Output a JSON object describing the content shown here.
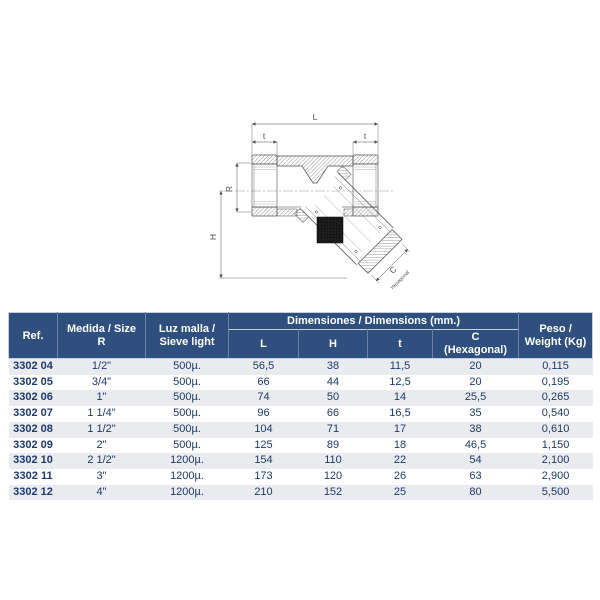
{
  "colors": {
    "header_bg": "#2F4F7F",
    "header_text": "#FFFFFF",
    "row_alt_bg": "#E9EBEE",
    "body_text": "#1E3A6E",
    "drawing_line": "#4F4F4F",
    "mesh_fill": "#161616",
    "page_bg": "#FFFFFF"
  },
  "diagram": {
    "labels": {
      "l": "L",
      "t_left": "t",
      "t_right": "t",
      "r": "R",
      "h": "H",
      "c": "C",
      "hexagonal": "Hexagonal"
    }
  },
  "table": {
    "header": {
      "ref": "Ref.",
      "size_l1": "Medida / Size",
      "size_l2": "R",
      "sieve_l1": "Luz malla /",
      "sieve_l2": "Sieve light",
      "dims_group": "Dimensiones / Dimensions (mm.)",
      "dim_l": "L",
      "dim_h": "H",
      "dim_t": "t",
      "dim_c_l1": "C",
      "dim_c_l2": "(Hexagonal)",
      "weight_l1": "Peso /",
      "weight_l2": "Weight (Kg)"
    },
    "rows": [
      [
        "3302 04",
        "1/2\"",
        "500µ.",
        "56,5",
        "38",
        "11,5",
        "20",
        "0,115"
      ],
      [
        "3302 05",
        "3/4\"",
        "500µ.",
        "66",
        "44",
        "12,5",
        "20",
        "0,195"
      ],
      [
        "3302 06",
        "1\"",
        "500µ.",
        "74",
        "50",
        "14",
        "25,5",
        "0,265"
      ],
      [
        "3302 07",
        "1 1/4\"",
        "500µ.",
        "96",
        "66",
        "16,5",
        "35",
        "0,540"
      ],
      [
        "3302 08",
        "1 1/2\"",
        "500µ.",
        "104",
        "71",
        "17",
        "38",
        "0,610"
      ],
      [
        "3302 09",
        "2\"",
        "500µ.",
        "125",
        "89",
        "18",
        "46,5",
        "1,150"
      ],
      [
        "3302 10",
        "2 1/2\"",
        "1200µ.",
        "154",
        "110",
        "22",
        "54",
        "2,100"
      ],
      [
        "3302 11",
        "3\"",
        "1200µ.",
        "173",
        "120",
        "26",
        "63",
        "2,900"
      ],
      [
        "3302 12",
        "4\"",
        "1200µ.",
        "210",
        "152",
        "25",
        "80",
        "5,500"
      ]
    ]
  }
}
